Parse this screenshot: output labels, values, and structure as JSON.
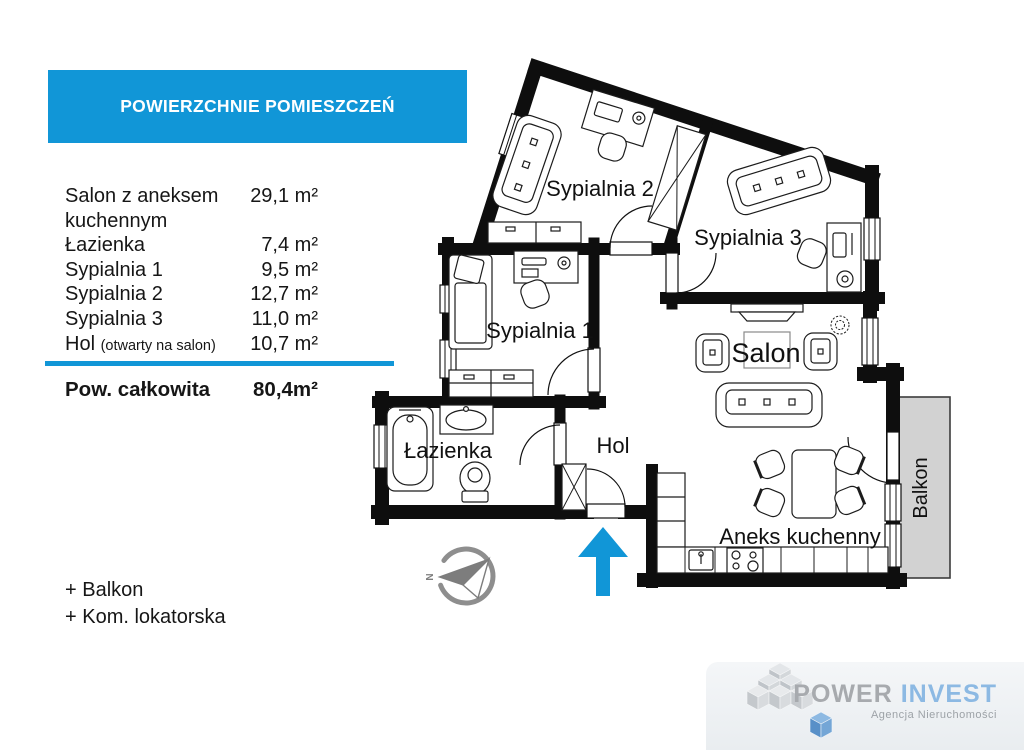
{
  "panel": {
    "header": "POWIERZCHNIE POMIESZCZEŃ",
    "rows": [
      {
        "label": "Salon z aneksem",
        "label2": "kuchennym",
        "value": "29,1 m²"
      },
      {
        "label": "Łazienka",
        "value": "7,4 m²"
      },
      {
        "label": "Sypialnia 1",
        "value": "9,5 m²"
      },
      {
        "label": "Sypialnia 2",
        "value": "12,7 m²"
      },
      {
        "label": "Sypialnia 3",
        "value": "11,0 m²"
      },
      {
        "label": "Hol",
        "note": "(otwarty na salon)",
        "value": "10,7 m²"
      }
    ],
    "total_label": "Pow. całkowita",
    "total_value": "80,4m²",
    "extras": [
      "+ Balkon",
      "+ Kom. lokatorska"
    ]
  },
  "plan": {
    "rooms": {
      "sypialnia2": "Sypialnia 2",
      "sypialnia3": "Sypialnia 3",
      "sypialnia1": "Sypialnia 1",
      "salon": "Salon",
      "lazienka": "Łazienka",
      "hol": "Hol",
      "aneks": "Aneks kuchenny",
      "balkon": "Balkon"
    },
    "compass_label": "N"
  },
  "logo": {
    "brand1": "POWER",
    "brand2": "INVEST",
    "tagline": "Agencja Nieruchomości"
  },
  "colors": {
    "accent": "#1196d7",
    "wall": "#0e0e0e",
    "balcony_fill": "#d2d2d2",
    "logo_gray": "#a7aaae",
    "logo_blue": "#8cb9e3"
  }
}
